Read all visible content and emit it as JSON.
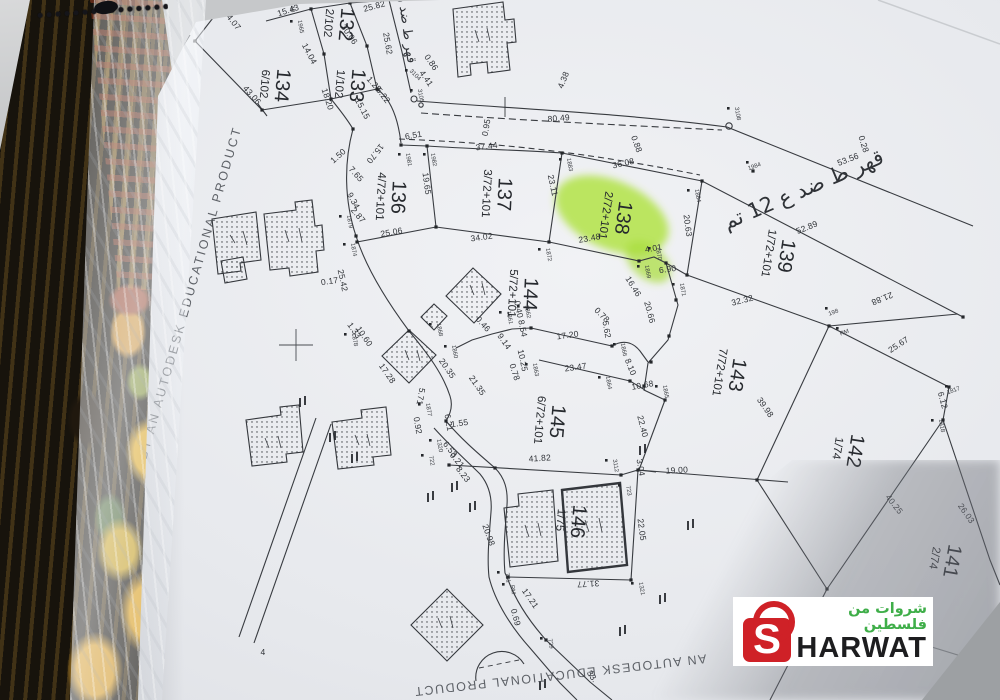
{
  "photo": {
    "paper_color": "#e9ebef",
    "ink_color": "#33363b",
    "highlight_color": "#aee23c",
    "watermark_side": "PRODUCED BY AN AUTODESK EDUCATIONAL PRODUCT",
    "watermark_bottom": "AN AUTODESK EDUCATIONAL PRODUCT",
    "logo": {
      "arabic": "شروات من فلسطين",
      "s": "S",
      "rest": "HARWAT",
      "red": "#cf2127",
      "green": "#3fae49"
    }
  },
  "map": {
    "road_labels": [
      {
        "text": "قهر ط ضد ع 12 تم",
        "x": 806,
        "y": 196,
        "r": -23,
        "s": 21
      },
      {
        "text": "قهر ط ضد ر",
        "x": 403,
        "y": 30,
        "r": 82,
        "s": 13
      }
    ],
    "parcels": [
      {
        "id": "132",
        "fr": "2/102",
        "x": 340,
        "y": 24,
        "r": 95
      },
      {
        "id": "133",
        "fr": "1/102",
        "x": 351,
        "y": 85,
        "r": 95
      },
      {
        "id": "134",
        "fr": "6/102",
        "x": 276,
        "y": 85,
        "r": 95
      },
      {
        "id": "136",
        "fr": "4/72+101",
        "x": 392,
        "y": 197,
        "r": 93
      },
      {
        "id": "137",
        "fr": "3/72+101",
        "x": 498,
        "y": 194,
        "r": 93
      },
      {
        "id": "138",
        "fr": "2/72+101",
        "x": 617,
        "y": 217,
        "r": 98,
        "hl": true
      },
      {
        "id": "139",
        "fr": "1/72+101",
        "x": 780,
        "y": 255,
        "r": 99
      },
      {
        "id": "144",
        "fr": "5/72+101",
        "x": 524,
        "y": 294,
        "r": 93
      },
      {
        "id": "143",
        "fr": "7/72+101",
        "x": 731,
        "y": 374,
        "r": 99
      },
      {
        "id": "145",
        "fr": "6/72+101",
        "x": 551,
        "y": 421,
        "r": 95
      },
      {
        "id": "142",
        "fr": "1/74",
        "x": 849,
        "y": 450,
        "r": 99
      },
      {
        "id": "146",
        "fr": "1/75",
        "x": 572,
        "y": 521,
        "r": 95
      },
      {
        "id": "141",
        "fr": "2/74",
        "x": 946,
        "y": 560,
        "r": 100
      }
    ],
    "dimensions": [
      [
        "25.82",
        375,
        9,
        -15
      ],
      [
        "15.43",
        289,
        13,
        -18
      ],
      [
        "24.07",
        230,
        22,
        52
      ],
      [
        "43.06",
        250,
        97,
        48
      ],
      [
        "30.06",
        347,
        36,
        55
      ],
      [
        "25.62",
        385,
        44,
        80
      ],
      [
        "14.04",
        307,
        55,
        62
      ],
      [
        "18.20",
        325,
        100,
        72
      ],
      [
        "15.15",
        360,
        110,
        62
      ],
      [
        "1.28",
        372,
        86,
        48
      ],
      [
        "5.22",
        381,
        97,
        52
      ],
      [
        "0.86",
        429,
        64,
        55
      ],
      [
        "4.41",
        424,
        80,
        55
      ],
      [
        "80.49",
        559,
        121,
        -5
      ],
      [
        "4.38",
        566,
        81,
        -68
      ],
      [
        "53.56",
        849,
        162,
        -21
      ],
      [
        "0.28",
        861,
        145,
        72
      ],
      [
        "6.51",
        414,
        138,
        -10
      ],
      [
        "37.44",
        487,
        149,
        -7
      ],
      [
        "0.95",
        489,
        128,
        -80
      ],
      [
        "15.70",
        373,
        152,
        128
      ],
      [
        "1.50",
        340,
        158,
        -42
      ],
      [
        "7.65",
        354,
        176,
        48
      ],
      [
        "9.34",
        351,
        202,
        62
      ],
      [
        "2.87",
        356,
        217,
        50
      ],
      [
        "19.65",
        424,
        184,
        82
      ],
      [
        "25.06",
        392,
        235,
        -10
      ],
      [
        "34.02",
        482,
        240,
        -8
      ],
      [
        "23.11",
        550,
        186,
        78
      ],
      [
        "36.08",
        624,
        166,
        -13
      ],
      [
        "0.88",
        634,
        145,
        70
      ],
      [
        "23.48",
        590,
        241,
        -10
      ],
      [
        "20.63",
        685,
        226,
        82
      ],
      [
        "4.01",
        654,
        251,
        -10
      ],
      [
        "6.90",
        668,
        272,
        -8
      ],
      [
        "52.89",
        808,
        230,
        -22
      ],
      [
        "21.88",
        881,
        296,
        158
      ],
      [
        "25.67",
        900,
        347,
        -33
      ],
      [
        "32.32",
        743,
        303,
        -14
      ],
      [
        "16.46",
        631,
        288,
        58
      ],
      [
        "20.66",
        647,
        313,
        75
      ],
      [
        "0.78",
        600,
        317,
        45
      ],
      [
        "5.62",
        604,
        330,
        80
      ],
      [
        "17.20",
        568,
        338,
        -8
      ],
      [
        "8.54",
        520,
        329,
        78
      ],
      [
        "0.40",
        516,
        310,
        78
      ],
      [
        "0.46",
        481,
        326,
        48
      ],
      [
        "9.14",
        502,
        343,
        55
      ],
      [
        "20.35",
        445,
        370,
        55
      ],
      [
        "21.35",
        475,
        387,
        55
      ],
      [
        "10.25",
        520,
        361,
        78
      ],
      [
        "0.78",
        512,
        373,
        72
      ],
      [
        "23.47",
        576,
        370,
        -8
      ],
      [
        "8.10",
        628,
        368,
        68
      ],
      [
        "10.68",
        643,
        388,
        -10
      ],
      [
        "22.40",
        640,
        427,
        76
      ],
      [
        "39.98",
        763,
        409,
        55
      ],
      [
        "41.82",
        540,
        461,
        -4
      ],
      [
        "3.04",
        638,
        468,
        80
      ],
      [
        "19.00",
        677,
        473,
        -3
      ],
      [
        "22.05",
        639,
        530,
        82
      ],
      [
        "31.77",
        588,
        581,
        177
      ],
      [
        "17.21",
        528,
        600,
        55
      ],
      [
        "0.69",
        513,
        618,
        75
      ],
      [
        "20.98",
        486,
        536,
        70
      ],
      [
        "1.55",
        460,
        426,
        -8
      ],
      [
        "6.21",
        446,
        423,
        80
      ],
      [
        "6.53",
        448,
        451,
        52
      ],
      [
        "0.21",
        455,
        462,
        50
      ],
      [
        "8.23",
        461,
        476,
        52
      ],
      [
        "0.92",
        415,
        426,
        80
      ],
      [
        "5.71",
        418,
        396,
        100
      ],
      [
        "17.28",
        385,
        375,
        55
      ],
      [
        "10.60",
        362,
        338,
        55
      ],
      [
        "1.33",
        352,
        332,
        55
      ],
      [
        "25.42",
        340,
        281,
        78
      ],
      [
        "0.17",
        330,
        284,
        -8
      ],
      [
        "6.12",
        940,
        401,
        75
      ],
      [
        "40.25",
        892,
        506,
        52
      ],
      [
        "26.03",
        964,
        515,
        55
      ],
      [
        "33.",
        590,
        678,
        55
      ],
      [
        "4",
        263,
        655,
        0
      ]
    ],
    "points": [
      [
        "1948",
        290,
        6
      ],
      [
        "1965",
        299,
        27
      ],
      [
        "1981",
        407,
        160
      ],
      [
        "1982",
        432,
        160
      ],
      [
        "1883",
        568,
        165
      ],
      [
        "1884",
        696,
        196
      ],
      [
        "1984",
        755,
        168,
        -20
      ],
      [
        "3108",
        736,
        114
      ],
      [
        "3104",
        414,
        76,
        45
      ],
      [
        "3105",
        419,
        96
      ],
      [
        "1870",
        657,
        254
      ],
      [
        "1871",
        681,
        290
      ],
      [
        "1872",
        547,
        255
      ],
      [
        "1869",
        646,
        272
      ],
      [
        "1879",
        348,
        222
      ],
      [
        "1874",
        352,
        250
      ],
      [
        "1862",
        526,
        312
      ],
      [
        "1861",
        508,
        318
      ],
      [
        "1868",
        438,
        330
      ],
      [
        "1860",
        453,
        352
      ],
      [
        "1863",
        534,
        370
      ],
      [
        "1866",
        622,
        350
      ],
      [
        "1864",
        607,
        383
      ],
      [
        "1865",
        664,
        392
      ],
      [
        "1877",
        427,
        410
      ],
      [
        "1878",
        353,
        340
      ],
      [
        "1320",
        438,
        446
      ],
      [
        "722",
        430,
        461
      ],
      [
        "723",
        627,
        491
      ],
      [
        "3112",
        614,
        466
      ],
      [
        "1321",
        640,
        589
      ],
      [
        "729",
        549,
        644
      ],
      [
        "721",
        506,
        578
      ],
      [
        "RM",
        845,
        334,
        -20
      ],
      [
        "RM",
        511,
        590
      ],
      [
        "198",
        834,
        314,
        -20
      ],
      [
        "1817",
        954,
        392,
        -20
      ],
      [
        "1818",
        940,
        426
      ]
    ]
  }
}
